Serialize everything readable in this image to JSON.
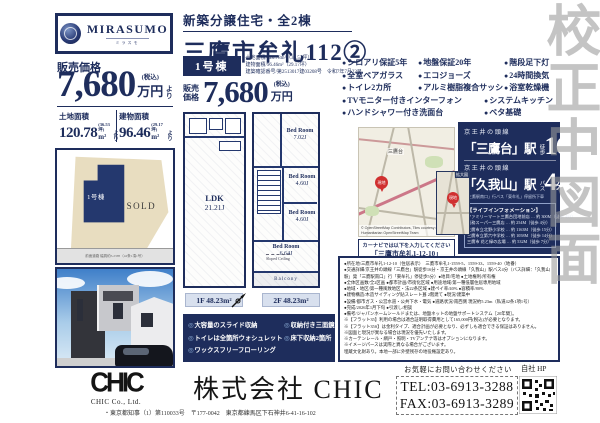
{
  "watermark": {
    "text": "校正中図面"
  },
  "logo": {
    "brand": "MIRASUMO",
    "kana": "ミラスモ"
  },
  "header": {
    "category": "新築分譲住宅・全2棟",
    "title": "三鷹市牟礼112②"
  },
  "price_panel": {
    "label": "販売価格",
    "amount": "7,680",
    "tax": "(税込)",
    "currency": "万円",
    "suffix": "より",
    "land_label": "土地面積",
    "land_value": "120.78",
    "land_tsubo": "(36.53坪)",
    "land_unit": "m²",
    "land_suffix": "より",
    "bldg_label": "建物面積",
    "bldg_value": "96.46",
    "bldg_tsubo": "(29.17坪)",
    "bldg_unit": "m²",
    "bldg_suffix": "より"
  },
  "site_plan": {
    "unit_label": "1号棟",
    "sold": "SOLD",
    "road_note": "前面道路 幅員約5.23ｍ（42条1項1号）"
  },
  "unit": {
    "tag": "1号棟",
    "spec1": "土地面積/120.78m²（36.53坪）",
    "spec2": "建物面積/96.46m²（29.17坪）",
    "spec3": "建築確認番号/第2513017建03208号　令和7年7月22日",
    "price_label": "販売価格",
    "amount": "7,680",
    "tax": "(税込)",
    "currency": "万円"
  },
  "floorplan": {
    "f1_name": "LDK",
    "f1_size": "21.21J",
    "f1_area": "1F 48.23m²",
    "f2_area": "2F 48.23m²",
    "f2_rooms": [
      {
        "name": "Bed Room",
        "size": "7.02J"
      },
      {
        "name": "Bed Room",
        "size": "4.60J"
      },
      {
        "name": "Bed Room",
        "size": "4.60J"
      },
      {
        "name": "Bed Room",
        "size": "6.64J"
      }
    ],
    "sloped": "Sloped Ceiling",
    "balcony": "Balcony"
  },
  "features": [
    "シロアリ保証5年",
    "地盤保証20年",
    "階段足下灯",
    "全室ペアガラス",
    "エコジョーズ",
    "24時間換気",
    "トイレ2カ所",
    "アルミ樹脂複合サッシ",
    "浴室乾燥機",
    "TVモニター付きインターフォン",
    "システムキッチン",
    "ハンドシャワー付き洗面台",
    "ベタ基礎"
  ],
  "interior": [
    "大容量のスライド収納",
    "トイレは全箇所ウォシュレット",
    "ワックスフリーフローリング",
    "収納付き三面鏡",
    "床下収納2箇所"
  ],
  "map": {
    "station_label": "三鷹台",
    "pin": "現地",
    "inset_title": "拡大図",
    "attribution": "© OpenStreetMap Contributors, Tiles courtesy of Humanitarian OpenStreetMap Team",
    "navi_line1": "カーナビでは以下を入力してください",
    "navi_line2": "「三鷹市牟礼1-12-10」"
  },
  "access": {
    "line1": "京王井の頭線",
    "station1": "「三鷹台」駅",
    "mode1": "徒歩",
    "time1": "16",
    "min1": "分",
    "line2": "京王井の頭線",
    "station2": "「久我山」駅",
    "mode2": "バス",
    "time2": "4",
    "min2": "分",
    "bus_note": "「三鷹駅南口」行バス「東牟礼」停留所下車"
  },
  "life_info": {
    "title": "【ライフインフォメーション】",
    "items": [
      "ファミリーマート三鷹台団地前店 … 約 300M（徒歩 4分）",
      "業務スーパー三鷹店 … 約 254M（徒歩 4分）",
      "三鷹市立北野小学校 … 約 1163M（徒歩 15分）",
      "三鷹市立第六中学校 … 約 1058M（徒歩 14分）",
      "三鷹市 花と緑の広場 … 約 532M（徒歩 7分）"
    ]
  },
  "remarks": [
    "●所在地/三鷹市牟礼1-12-10（住居表示）　三鷹市牟礼1-1559-5、1559-33、1559-40（地番）",
    "●交通詳細/京王井の頭線「三鷹台」駅徒歩16分・京王井の頭線「久我山」駅バス4分（バス詳細：「久我山駅」発「三鷹駅南口」行「東牟礼」停徒歩5分）●地目/宅地 ●土地権利/所有権",
    "●全体区画数/全2区画 ●都市計画/市街化区域 ●用途地域/第一種低層住居専用地域",
    "●地域・地区/第一種風致地区・法22条区域 ●建ペイ率/40% ●容積率/80%",
    "●建物構造/木造サイディング貼スレート葺 2階建て ●現況/建築中",
    "●設備/都市ガス・公営水道・公共下水・電気 ●道路状況/南西側 現況約5.23m（私道42条1項1号）",
    "●完成/2026年1月下旬 ●引渡し/相談",
    "●備考/ジャパンホームシールドまたは、地盤ネットの地盤サポートシステム［20年間］。",
    "※【フラット35】利用の場合は適合証明取得費用として165,000円(税込)が必要となります。",
    "※【フラット35S】は金利タイプ、適合計画が必要となり、必ずしも適合できる保証はありません。",
    "※図面と現況が異なる場合は現況を優先いたします。",
    "※カーテンレール・網戸・照明・TVアンテナ等はオプションになります。",
    "※イメージパースは実際と異なる場合がございます。",
    "埋蔵文化財あり。本地一部に外壁残存の地役権設定あり。"
  ],
  "footer": {
    "logo": "CHIC",
    "logo_sub": "CHIC Co., Ltd.",
    "company": "株式会社 CHIC",
    "license": "・東京都知事（1）第110033号　〒177-0042　東京都練馬区下石神井6-41-16-102",
    "contact": "お気軽にお問い合わせください",
    "tel": "TEL:03-6913-3288",
    "fax": "FAX:03-6913-3289",
    "hp": "自社 HP"
  }
}
